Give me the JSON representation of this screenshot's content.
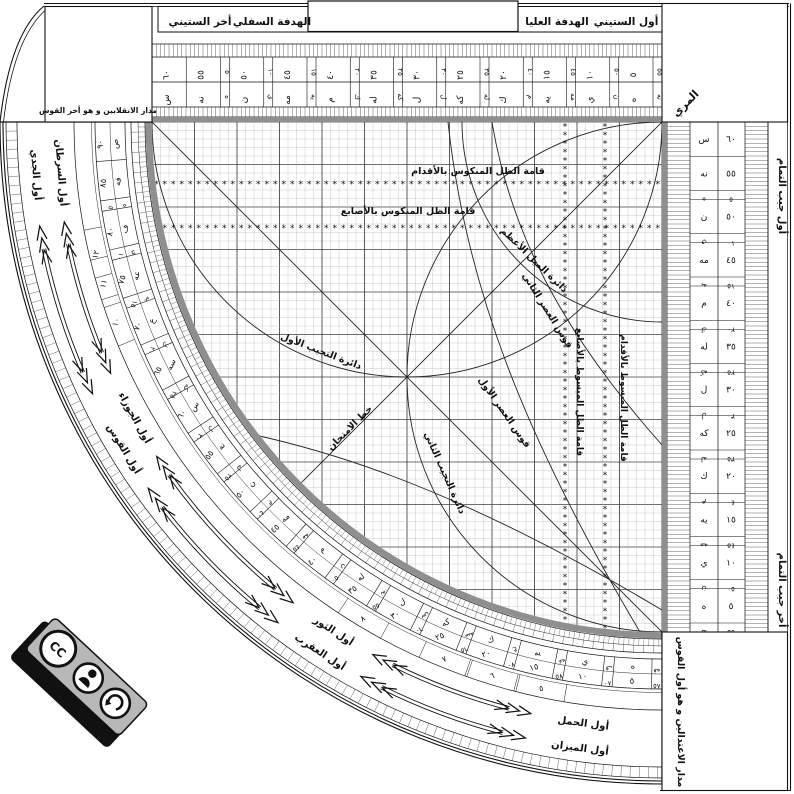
{
  "title_bar": {
    "akhir_sittini": "أخر الستيني",
    "hadafa_sufla": "الهدفة السفلي",
    "hadafa_ulya": "الهدفة العليا",
    "awwal_sittini": "أول الستيني"
  },
  "corner_boxes": {
    "top_left": "مدار الانقلابين و هو أخر القوس",
    "top_right": "المري",
    "bottom_right": "مدار الاعتدالين و هو أول القوس"
  },
  "right_margin": {
    "top": "أول جيب التمام",
    "bottom": "أخر جيب التمام"
  },
  "grid_labels": {
    "mankus_feet": "قامة الظل المنكوس بالأقدام",
    "mankus_fingers": "قامة الظل المنكوس بالأصابع",
    "mabsut_fingers": "قامة الظل المبسوط بالأصابع",
    "mabsut_feet": "قامة الظل المبسوط بالأقدام",
    "mayl": "دائرة الميل الأعظم",
    "asr2": "قوس العصر الثاني",
    "asr1": "قوس العصر الأول",
    "tajyib1": "دائرة التجيب الأول",
    "tajyib2": "دائرة التجيب الثاني",
    "imtihan": "خط الامتحان"
  },
  "grid": {
    "star_rows": [
      {
        "y": 184
      },
      {
        "y": 228
      }
    ],
    "star_cols": [
      {
        "x": 565
      },
      {
        "x": 605
      }
    ]
  },
  "scales": {
    "limb_main": [
      [
        "٩٠",
        "ص"
      ],
      [
        "٨٥",
        "فه"
      ],
      [
        "٨٠",
        "ف"
      ],
      [
        "٧٥",
        "عه"
      ],
      [
        "٧٠",
        "ع"
      ],
      [
        "٦٥",
        "سه"
      ],
      [
        "٦٠",
        "س"
      ],
      [
        "٥٥",
        "نه"
      ],
      [
        "٥٠",
        "ن"
      ],
      [
        "٤٥",
        "مه"
      ],
      [
        "٤٠",
        "م"
      ],
      [
        "٣٥",
        "له"
      ],
      [
        "٣٠",
        "ل"
      ],
      [
        "٢٥",
        "كه"
      ],
      [
        "٢٠",
        "ك"
      ],
      [
        "١٥",
        "يه"
      ],
      [
        "١٠",
        "ي"
      ],
      [
        "٥",
        "ه"
      ]
    ],
    "limb_complement": [
      "٥",
      "١٠",
      "١٥",
      "٢٠",
      "٢٥",
      "٣٠",
      "٣٥",
      "٤٠",
      "٤٥",
      "٥٠",
      "٥٥",
      "٦٠",
      "٦٥",
      "٧٠",
      "٧٥",
      "٨٠",
      "٨٥"
    ],
    "sexagesimal_main": [
      [
        "٦٠",
        "س"
      ],
      [
        "٥٥",
        "نه"
      ],
      [
        "٥٠",
        "ن"
      ],
      [
        "٤٥",
        "مه"
      ],
      [
        "٤٠",
        "م"
      ],
      [
        "٣٥",
        "له"
      ],
      [
        "٣٠",
        "ل"
      ],
      [
        "٢٥",
        "كه"
      ],
      [
        "٢٠",
        "ك"
      ],
      [
        "١٥",
        "يه"
      ],
      [
        "١٠",
        "ي"
      ],
      [
        "٥",
        "ه"
      ]
    ],
    "sexagesimal_complement": [
      "٥",
      "١٠",
      "١٥",
      "٢٠",
      "٢٥",
      "٣٠",
      "٣٥",
      "٤٠",
      "٤٥",
      "٥٠",
      "٥٥"
    ],
    "lane_digits": [
      {
        "v": "١٢",
        "t": 13
      },
      {
        "v": "١١",
        "t": 16
      },
      {
        "v": "١٠",
        "t": 20
      },
      {
        "v": "٨",
        "t": 59
      },
      {
        "v": "٧",
        "t": 68
      },
      {
        "v": "٦",
        "t": 73
      },
      {
        "v": "٥",
        "t": 78
      }
    ]
  },
  "zodiac": {
    "inner": [
      {
        "label": "أول السرطان",
        "t": 4.5
      },
      {
        "label": "أول الجوزاء",
        "t": 29
      },
      {
        "label": "أول الثور",
        "t": 57
      },
      {
        "label": "أول الحمل",
        "t": 82.5
      }
    ],
    "outer": [
      {
        "label": "أول الجدي",
        "t": 4.5
      },
      {
        "label": "أول القوس",
        "t": 31
      },
      {
        "label": "أول العقرب",
        "t": 57
      },
      {
        "label": "أول الميزان",
        "t": 82.5
      }
    ]
  },
  "badge": {
    "cc": "CC",
    "by": "BY",
    "sa": "SA"
  },
  "colors": {
    "ink": "#111111",
    "gray_band": "#8f8f8f",
    "badge_gray": "#b8b8b8"
  }
}
